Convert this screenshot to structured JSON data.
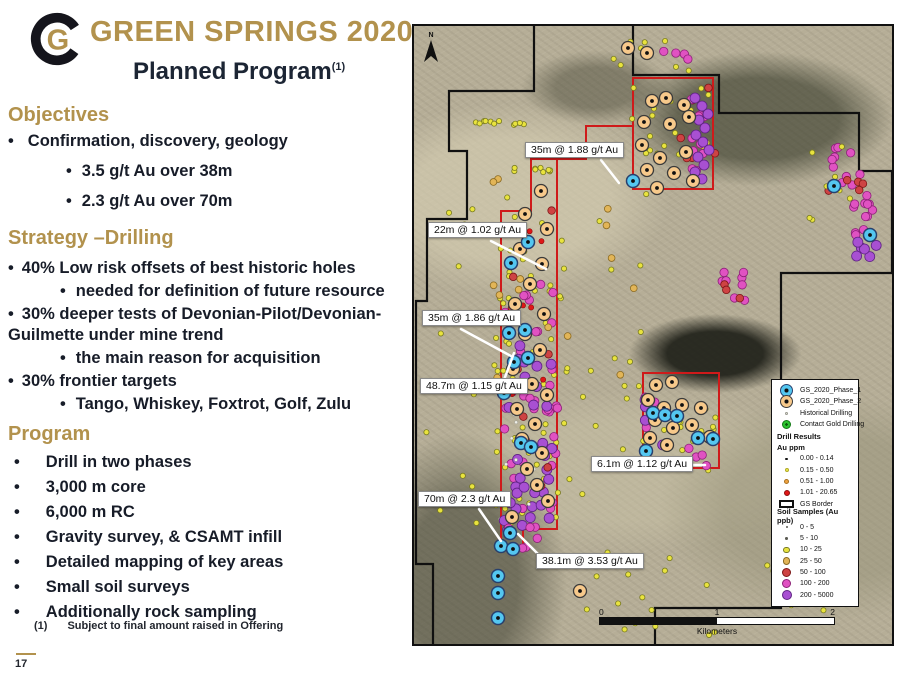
{
  "slide": {
    "logo_letter": "G",
    "title": "GREEN SPRINGS 2020",
    "subtitle": "Planned Program",
    "subtitle_sup": "(1)",
    "footnote_marker": "(1)",
    "footnote": "Subject to final amount raised in Offering",
    "page_number": "17",
    "colors": {
      "accent_gold": "#b2924d",
      "body_navy": "#1b2433"
    }
  },
  "sections": [
    {
      "heading": "Objectives",
      "items": [
        {
          "l": 1,
          "t": "Confirmation, discovery, geology"
        },
        {
          "l": 2,
          "t": "3.5 g/t Au over 38m"
        },
        {
          "l": 2,
          "t": "2.3 g/t Au over 70m"
        }
      ]
    },
    {
      "heading": "Strategy –Drilling",
      "items": [
        {
          "l": 1,
          "t": "40% Low risk offsets of best historic holes"
        },
        {
          "l": 2,
          "t": "needed for definition of future resource"
        },
        {
          "l": 1,
          "t": "30% deeper tests of Devonian-Pilot/Devonian-Guilmette under mine trend"
        },
        {
          "l": 2,
          "t": "the main reason for acquisition"
        },
        {
          "l": 1,
          "t": "30% frontier targets"
        },
        {
          "l": 2,
          "t": "Tango, Whiskey, Foxtrot, Golf, Zulu"
        }
      ]
    },
    {
      "heading": "Program",
      "items": [
        {
          "l": 1,
          "t": "Drill in two phases"
        },
        {
          "l": 1,
          "t": "3,000 m core"
        },
        {
          "l": 1,
          "t": "6,000 m RC"
        },
        {
          "l": 1,
          "t": "Gravity survey, & CSAMT infill"
        },
        {
          "l": 1,
          "t": "Detailed mapping of key areas"
        },
        {
          "l": 1,
          "t": "Small soil surveys"
        },
        {
          "l": 1,
          "t": "Additionally rock sampling"
        }
      ]
    }
  ],
  "map": {
    "north_label": "N",
    "colors": {
      "map_red": "#cf1a1a",
      "border_black": "#101010",
      "leader_white": "#ffffff"
    },
    "callouts": [
      {
        "text": "35m @ 1.88 g/t Au",
        "left": 111,
        "top": 116,
        "line": [
          187,
          134,
          205,
          157
        ]
      },
      {
        "text": "22m @ 1.02 g/t Au",
        "left": 14,
        "top": 196,
        "line": [
          77,
          215,
          132,
          243
        ]
      },
      {
        "text": "35m @ 1.86 g/t Au",
        "left": 8,
        "top": 284,
        "line": [
          47,
          303,
          97,
          330
        ]
      },
      {
        "text": "48.7m @ 1.15 g/t Au",
        "left": 6,
        "top": 352,
        "line": [
          87,
          362,
          100,
          327
        ]
      },
      {
        "text": "6.1m @ 1.12 g/t Au",
        "left": 177,
        "top": 430,
        "line": [
          259,
          439,
          291,
          439
        ]
      },
      {
        "text": "70m @ 2.3 g/t Au",
        "left": 4,
        "top": 465,
        "line": [
          65,
          483,
          87,
          515
        ]
      },
      {
        "text": "38.1m @ 3.53 g/t Au",
        "left": 122,
        "top": 527,
        "line": [
          127,
          531,
          104,
          508
        ]
      }
    ],
    "legend": {
      "rows": [
        {
          "sym": "p1",
          "label": "GS_2020_Phase_1"
        },
        {
          "sym": "p2",
          "label": "GS_2020_Phase_2"
        },
        {
          "sym": "hist",
          "label": "Historical Drilling"
        },
        {
          "sym": "green",
          "label": "Contact Gold Drilling"
        },
        {
          "head": "Drill Results"
        },
        {
          "head": "Au ppm"
        },
        {
          "sym": "dr0",
          "label": "0.00 - 0.14"
        },
        {
          "sym": "dr1",
          "label": "0.15 - 0.50"
        },
        {
          "sym": "dr2",
          "label": "0.51 - 1.00"
        },
        {
          "sym": "dr3",
          "label": "1.01 - 20.65"
        },
        {
          "sym": "border",
          "label": "GS Border"
        },
        {
          "head": "Soil Samples (Au ppb)"
        },
        {
          "sym": "s0",
          "label": "0 - 5"
        },
        {
          "sym": "s1",
          "label": "5 - 10"
        },
        {
          "sym": "s2",
          "label": "10 - 25"
        },
        {
          "sym": "s3",
          "label": "25 - 50"
        },
        {
          "sym": "s4",
          "label": "50 - 100"
        },
        {
          "sym": "s5",
          "label": "100 - 200"
        },
        {
          "sym": "s6",
          "label": "200 - 5000"
        }
      ]
    },
    "scalebar": {
      "ticks": [
        "0",
        "1",
        "2"
      ],
      "unit": "Kilometers"
    },
    "symbols": {
      "p1": {
        "fill": "#54c7f0",
        "stroke": "#27406e",
        "sw": 1.5,
        "r": 6.5,
        "dot": "#101010",
        "ls": 13
      },
      "p2": {
        "fill": "#f7c98b",
        "stroke": "#3a3a3a",
        "sw": 1.3,
        "r": 6.5,
        "dot": "#101010",
        "ls": 13
      },
      "hist": {
        "fill": "#eeeee6",
        "stroke": "#9a9a90",
        "sw": 0.5,
        "r": 1.6,
        "ls": 3
      },
      "green": {
        "fill": "#2bc32f",
        "stroke": "#117a14",
        "sw": 1,
        "r": 4.5,
        "dot": "#0b5c0d",
        "ls": 9
      },
      "dr0": {
        "fill": "#141414",
        "r": 1.2,
        "ls": 2.5
      },
      "dr1": {
        "fill": "#f1ee52",
        "stroke": "#b0aa28",
        "sw": 0.5,
        "r": 1.8,
        "ls": 4
      },
      "dr2": {
        "fill": "#efa23f",
        "stroke": "#a8711f",
        "sw": 0.5,
        "r": 2.2,
        "ls": 5
      },
      "dr3": {
        "fill": "#df1717",
        "stroke": "#8d0d0d",
        "sw": 0.6,
        "r": 2.6,
        "ls": 6
      },
      "s0": {
        "fill": "#5a5a52",
        "r": 1,
        "ls": 2
      },
      "s1": {
        "fill": "#5a5a52",
        "r": 1.4,
        "ls": 2.8
      },
      "s2": {
        "fill": "#e9e33e",
        "stroke": "#787a22",
        "sw": 0.8,
        "r": 2.6,
        "ls": 6.5
      },
      "s3": {
        "fill": "#e2b557",
        "stroke": "#8a6a22",
        "sw": 0.8,
        "r": 3.4,
        "ls": 7.5
      },
      "s4": {
        "fill": "#ce4343",
        "stroke": "#7c1616",
        "sw": 0.8,
        "r": 3.8,
        "ls": 9
      },
      "s5": {
        "fill": "#e052c2",
        "stroke": "#8c2177",
        "sw": 0.8,
        "r": 4.2,
        "ls": 9
      },
      "s6": {
        "fill": "#a850d2",
        "stroke": "#5e2383",
        "sw": 0.8,
        "r": 5,
        "ls": 10
      }
    },
    "shapes": {
      "border": [
        "M120,0 L120,65 L35,65 L35,125 L53,125 L53,193 L13,193 L13,275 L2,275 L2,538 L19,538 L19,618",
        "M219,0 L219,49 L305,49 L305,87 L445,87 L445,145 L478,145 L478,247 L367,247 L367,582 L241,582 L241,620"
      ],
      "red": [
        "M219,52 L299,52 L299,163 L219,163 Z",
        "M219,100 L172,100 L172,133 L143,133",
        "M143,133 L143,503 L109,503 L109,521 L87,521 L87,185 L117,185 L117,133 Z",
        "M229,347 L305,347 L305,442 L229,442 Z"
      ]
    },
    "clusters": [
      [
        "s2",
        114,
        335,
        70,
        330,
        60
      ],
      [
        "s5",
        117,
        375,
        55,
        260,
        40
      ],
      [
        "s6",
        115,
        405,
        50,
        180,
        25
      ],
      [
        "s4",
        112,
        325,
        60,
        300,
        10
      ],
      [
        "s3",
        107,
        275,
        60,
        250,
        10
      ],
      [
        "hist",
        102,
        445,
        40,
        120,
        12
      ],
      [
        "s2",
        84,
        97,
        52,
        5,
        11
      ],
      [
        "s2",
        122,
        144,
        45,
        5,
        9
      ],
      [
        "s2",
        255,
        115,
        85,
        110,
        22
      ],
      [
        "s4",
        277,
        95,
        50,
        90,
        7
      ],
      [
        "s5",
        287,
        115,
        30,
        120,
        10
      ],
      [
        "s2",
        237,
        30,
        90,
        30,
        8
      ],
      [
        "s5",
        255,
        25,
        40,
        20,
        4
      ],
      [
        "s2",
        267,
        400,
        85,
        90,
        18
      ],
      [
        "s5",
        259,
        405,
        70,
        70,
        9
      ],
      [
        "s6",
        252,
        400,
        55,
        60,
        6
      ],
      [
        "s5",
        432,
        140,
        40,
        40,
        10
      ],
      [
        "s4",
        432,
        160,
        35,
        15,
        5
      ],
      [
        "s5",
        453,
        190,
        30,
        45,
        12
      ],
      [
        "s6",
        455,
        220,
        25,
        30,
        6
      ],
      [
        "s2",
        417,
        155,
        60,
        80,
        8
      ],
      [
        "s5",
        322,
        260,
        28,
        30,
        8
      ],
      [
        "s4",
        322,
        268,
        25,
        25,
        3
      ],
      [
        "s2",
        227,
        565,
        150,
        90,
        16
      ],
      [
        "s2",
        377,
        560,
        90,
        50,
        8
      ],
      [
        "s2",
        187,
        325,
        80,
        300,
        20
      ],
      [
        "s3",
        187,
        305,
        70,
        250,
        6
      ],
      [
        "s2",
        47,
        405,
        70,
        260,
        8
      ],
      [
        "s6",
        112,
        475,
        45,
        60,
        10
      ],
      [
        "s5",
        107,
        520,
        40,
        40,
        6
      ],
      [
        "s2",
        57,
        205,
        50,
        80,
        4
      ],
      [
        "dr3",
        112,
        300,
        40,
        200,
        8
      ]
    ],
    "points": {
      "s6": [
        [
          281,
          72
        ],
        [
          288,
          80
        ],
        [
          294,
          88
        ],
        [
          285,
          94
        ],
        [
          291,
          102
        ],
        [
          282,
          109
        ],
        [
          289,
          116
        ],
        [
          295,
          124
        ],
        [
          284,
          131
        ],
        [
          290,
          139
        ],
        [
          281,
          146
        ],
        [
          288,
          153
        ]
      ],
      "p2": [
        [
          238,
          75
        ],
        [
          252,
          72
        ],
        [
          270,
          79
        ],
        [
          230,
          96
        ],
        [
          256,
          98
        ],
        [
          275,
          91
        ],
        [
          228,
          119
        ],
        [
          246,
          132
        ],
        [
          272,
          126
        ],
        [
          233,
          144
        ],
        [
          260,
          147
        ],
        [
          243,
          162
        ],
        [
          279,
          155
        ],
        [
          127,
          165
        ],
        [
          111,
          188
        ],
        [
          133,
          203
        ],
        [
          106,
          223
        ],
        [
          128,
          238
        ],
        [
          116,
          258
        ],
        [
          101,
          278
        ],
        [
          130,
          288
        ],
        [
          111,
          308
        ],
        [
          126,
          324
        ],
        [
          99,
          343
        ],
        [
          118,
          358
        ],
        [
          133,
          369
        ],
        [
          103,
          383
        ],
        [
          121,
          398
        ],
        [
          108,
          413
        ],
        [
          128,
          427
        ],
        [
          113,
          443
        ],
        [
          123,
          459
        ],
        [
          134,
          475
        ],
        [
          98,
          491
        ],
        [
          242,
          359
        ],
        [
          258,
          356
        ],
        [
          234,
          374
        ],
        [
          250,
          382
        ],
        [
          268,
          379
        ],
        [
          287,
          382
        ],
        [
          241,
          394
        ],
        [
          259,
          402
        ],
        [
          278,
          399
        ],
        [
          236,
          412
        ],
        [
          253,
          419
        ],
        [
          296,
          411
        ],
        [
          166,
          565
        ],
        [
          214,
          22
        ],
        [
          233,
          27
        ]
      ],
      "p1": [
        [
          219,
          155
        ],
        [
          114,
          216
        ],
        [
          97,
          237
        ],
        [
          111,
          304
        ],
        [
          95,
          307
        ],
        [
          114,
          332
        ],
        [
          100,
          336
        ],
        [
          90,
          367
        ],
        [
          107,
          417
        ],
        [
          117,
          421
        ],
        [
          87,
          520
        ],
        [
          99,
          523
        ],
        [
          84,
          550
        ],
        [
          84,
          567
        ],
        [
          84,
          592
        ],
        [
          96,
          507
        ],
        [
          239,
          387
        ],
        [
          251,
          389
        ],
        [
          263,
          390
        ],
        [
          299,
          413
        ],
        [
          232,
          425
        ],
        [
          420,
          160
        ],
        [
          456,
          209
        ],
        [
          284,
          412
        ]
      ]
    }
  }
}
